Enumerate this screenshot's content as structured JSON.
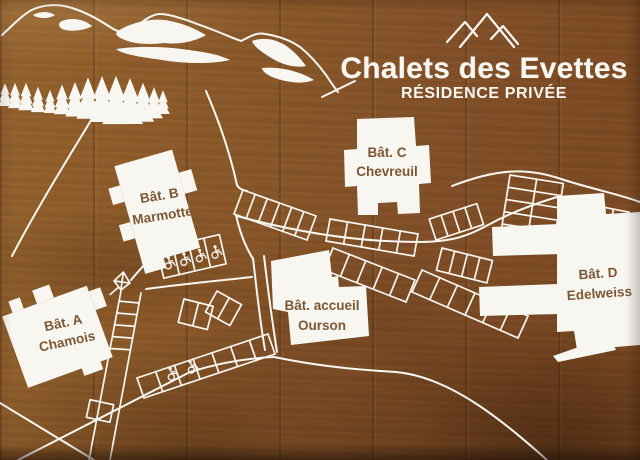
{
  "sign": {
    "title": "Chalets des Evettes",
    "subtitle": "RÉSIDENCE PRIVÉE",
    "logo_icon": "three-peaks-mountain-icon"
  },
  "buildings": [
    {
      "id": "A",
      "line1": "Bât. A",
      "line2": "Chamois"
    },
    {
      "id": "B",
      "line1": "Bât. B",
      "line2": "Marmotte"
    },
    {
      "id": "C",
      "line1": "Bât. C",
      "line2": "Chevreuil"
    },
    {
      "id": "accueil",
      "line1": "Bât. accueil",
      "line2": "Ourson"
    },
    {
      "id": "D",
      "line1": "Bât. D",
      "line2": "Edelweiss"
    }
  ],
  "map_features": {
    "accessible_parking_icon": "wheelchair-icon",
    "accessible_spaces_near_building_b": 4,
    "accessible_spaces_south_row": 2,
    "marker_icon": "kite-marker-icon",
    "decor_icons": [
      "mountain-range-icon",
      "pine-forest-icon"
    ]
  },
  "colors": {
    "wood": "#8a5a2c",
    "artwork": "#f8f6f1",
    "label_text": "#7d5734"
  }
}
